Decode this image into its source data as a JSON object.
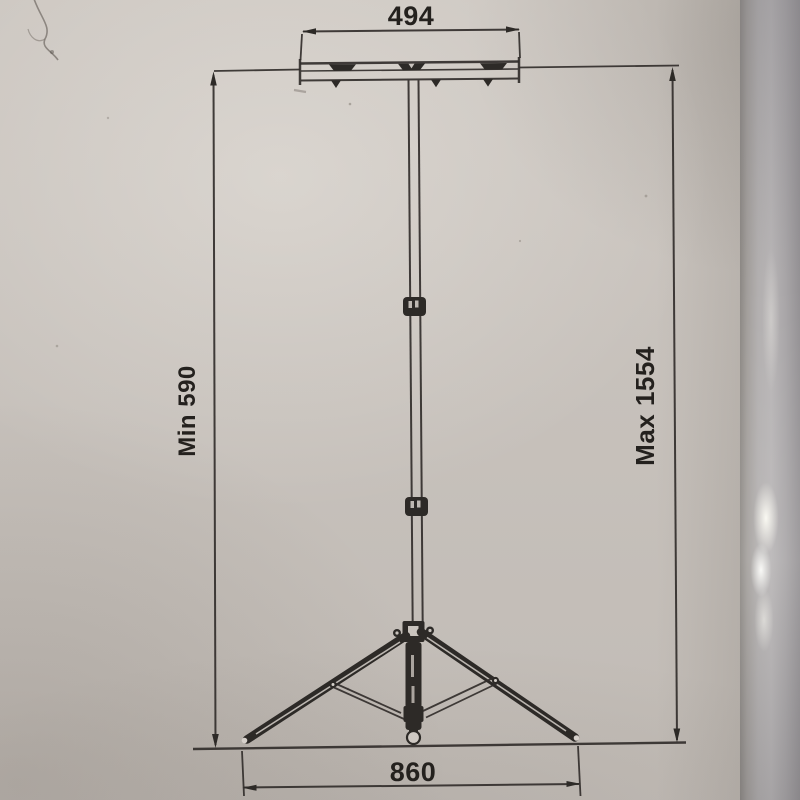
{
  "diagram": {
    "type": "technical-dimension-drawing",
    "subject": "telescopic tripod stand",
    "labels": {
      "top_width": "494",
      "min_height": "Min 590",
      "max_height": "Max 1554",
      "base_width": "860"
    },
    "colors": {
      "paper": "#c9c3bd",
      "ink": "#2e2a27",
      "page_edge": "#b3b0b0"
    }
  }
}
